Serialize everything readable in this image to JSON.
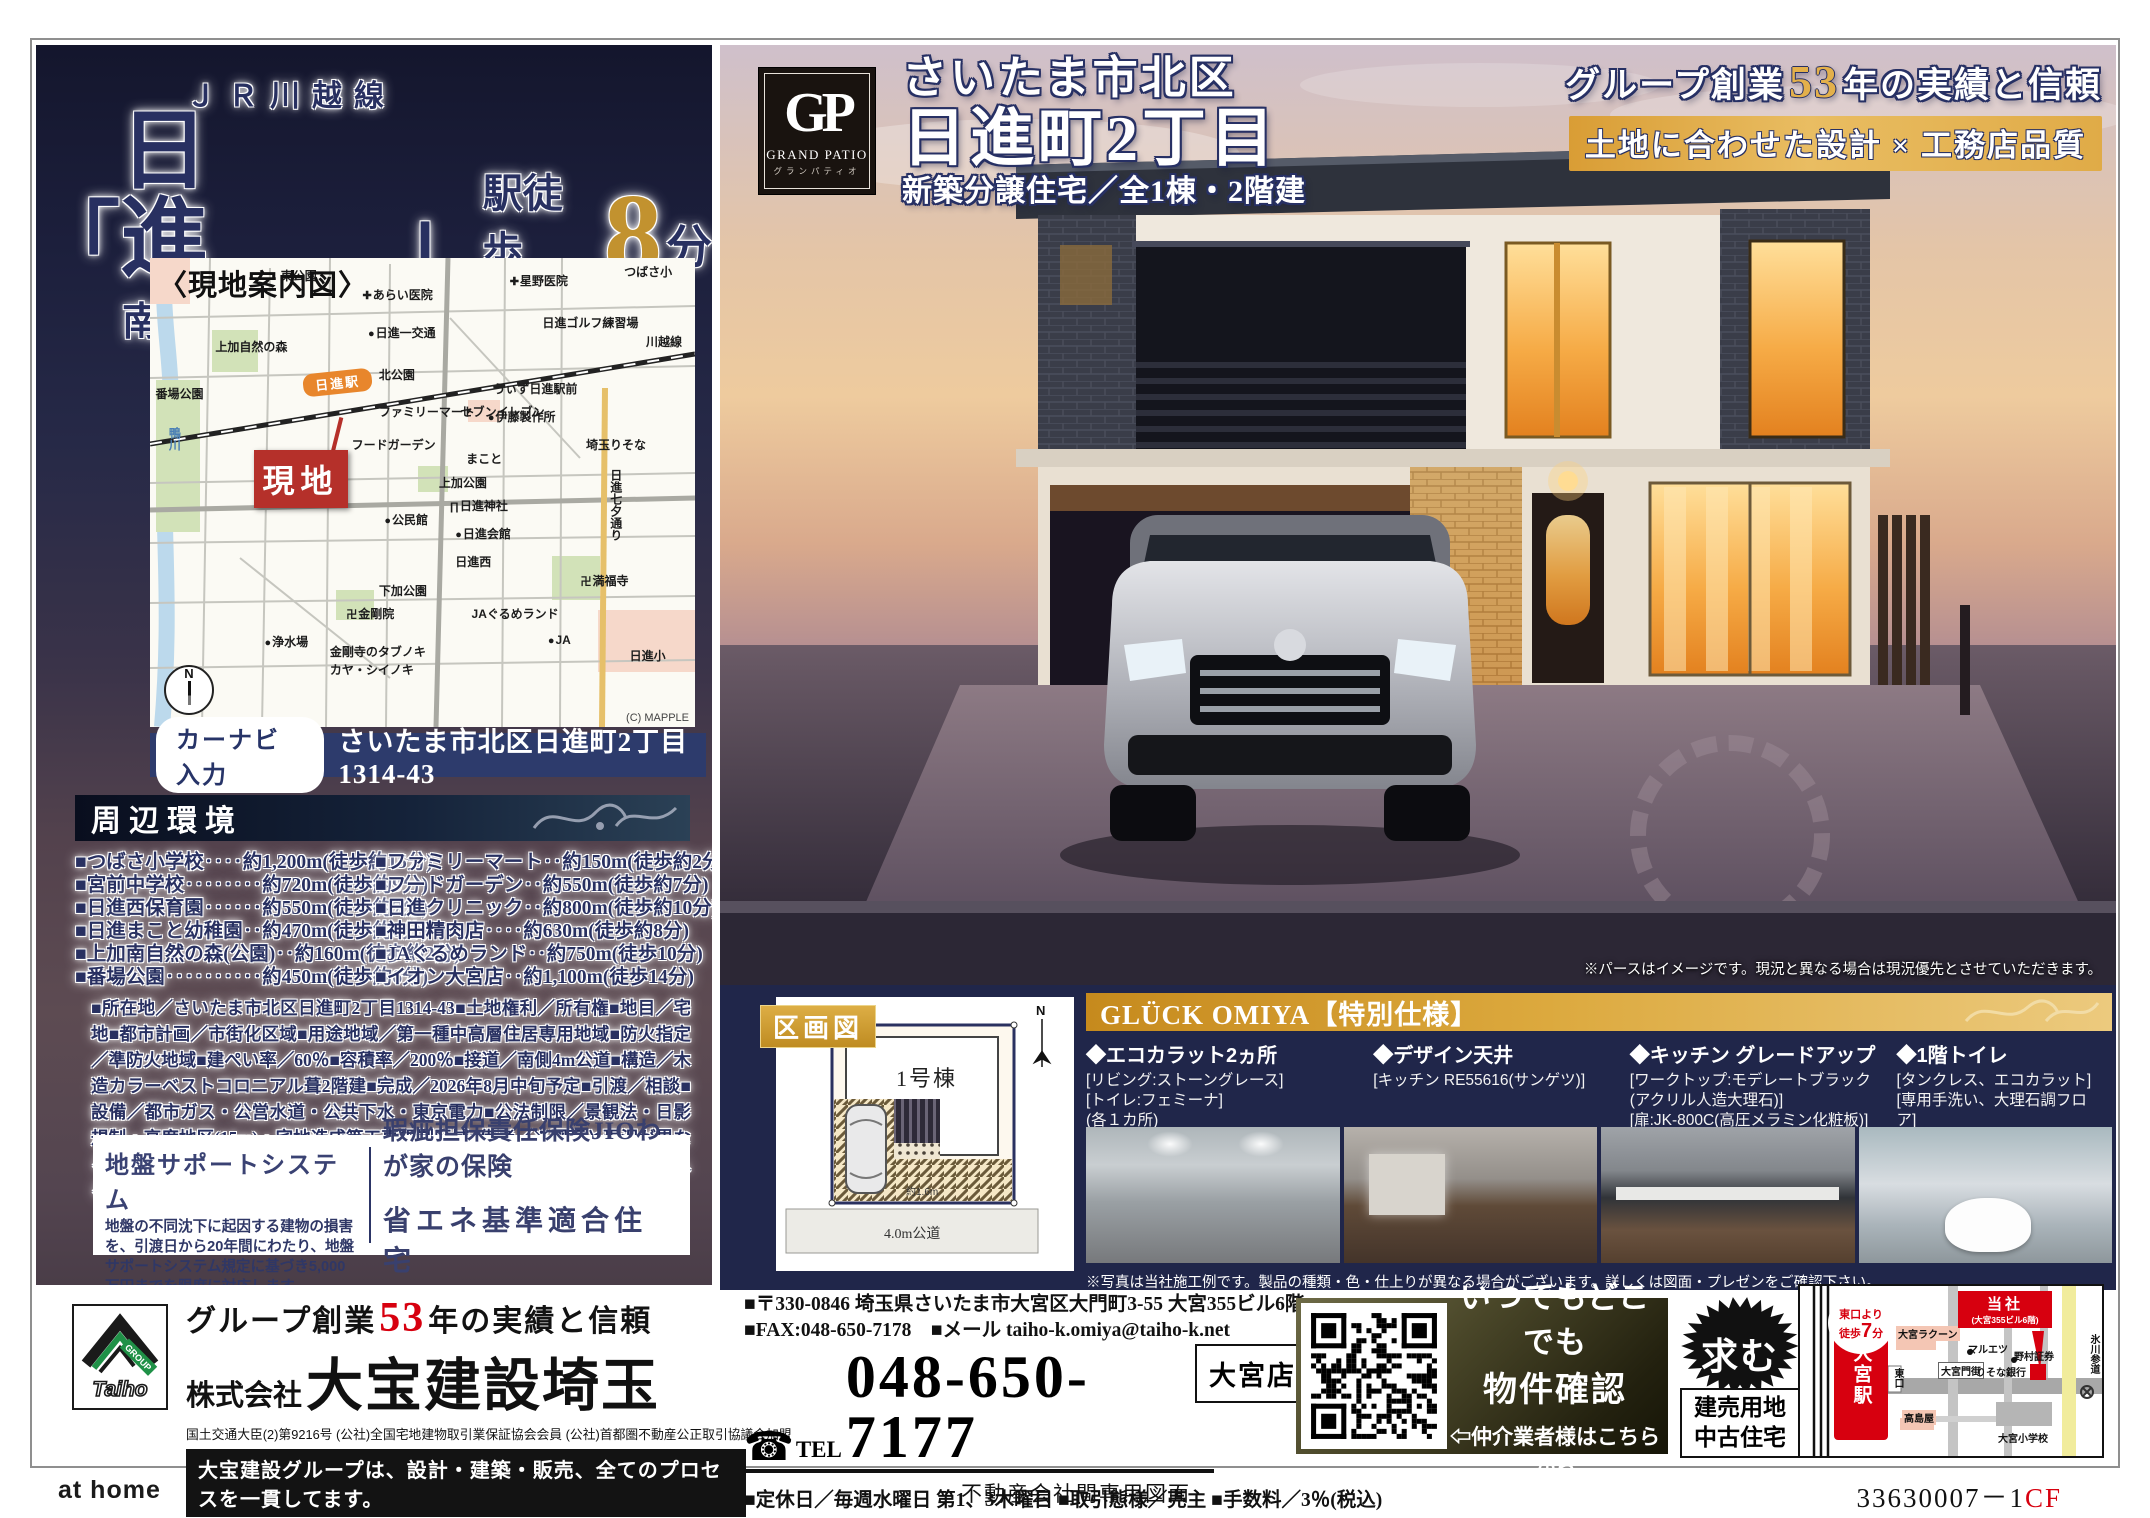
{
  "colors": {
    "navy": "#283061",
    "gold": "#c2922f",
    "red": "#d7000f",
    "panel_navy": "#20264a",
    "accent_gold_bar": "#dca93e"
  },
  "left": {
    "train_line": "ＪＲ川越線",
    "quote_open": "「",
    "station_name": "日　進",
    "quote_close": "」",
    "walk_label": "駅徒歩",
    "walk_minutes": "8",
    "walk_unit": "分",
    "subtitle": "南道路のため陽あたり良好",
    "map": {
      "title": "〈現地案内図〉",
      "site_label": "現地",
      "station_label": "日進駅",
      "credit": "(C) MAPPLE",
      "compass": "N",
      "labels": [
        {
          "t": "東公園",
          "x": 24,
          "y": 2
        },
        {
          "t": "あらい医院",
          "x": 39,
          "y": 6,
          "icon": "hospital"
        },
        {
          "t": "星野医院",
          "x": 66,
          "y": 3,
          "icon": "hospital"
        },
        {
          "t": "つばさ小",
          "x": 87,
          "y": 1
        },
        {
          "t": "日進ゴルフ練習場",
          "x": 72,
          "y": 12
        },
        {
          "t": "日進一交通",
          "x": 40,
          "y": 14,
          "icon": "dot"
        },
        {
          "t": "上加自然の森",
          "x": 12,
          "y": 17
        },
        {
          "t": "北公園",
          "x": 42,
          "y": 23
        },
        {
          "t": "番場公園",
          "x": 1,
          "y": 27
        },
        {
          "t": "うぃず日進駅前",
          "x": 63,
          "y": 26
        },
        {
          "t": "伊藤製作所",
          "x": 62,
          "y": 32,
          "icon": "dot"
        },
        {
          "t": "ファミリーマート",
          "x": 42,
          "y": 31
        },
        {
          "t": "セブンイレブン",
          "x": 57,
          "y": 31
        },
        {
          "t": "川越線",
          "x": 91,
          "y": 16
        },
        {
          "t": "フードガーデン",
          "x": 37,
          "y": 38
        },
        {
          "t": "まこと",
          "x": 58,
          "y": 41
        },
        {
          "t": "埼玉りそな",
          "x": 80,
          "y": 38
        },
        {
          "t": "鴨川",
          "x": 3,
          "y": 36,
          "vert": true,
          "river": true
        },
        {
          "t": "上加公園",
          "x": 53,
          "y": 46
        },
        {
          "t": "日進神社",
          "x": 55,
          "y": 51,
          "icon": "torii"
        },
        {
          "t": "公民館",
          "x": 43,
          "y": 54,
          "icon": "dot"
        },
        {
          "t": "日進会館",
          "x": 56,
          "y": 57,
          "icon": "dot"
        },
        {
          "t": "日進七夕通り",
          "x": 84,
          "y": 45,
          "vert": true
        },
        {
          "t": "日進西",
          "x": 56,
          "y": 63
        },
        {
          "t": "下加公園",
          "x": 42,
          "y": 69
        },
        {
          "t": "満福寺",
          "x": 79,
          "y": 67,
          "icon": "temple"
        },
        {
          "t": "金剛院",
          "x": 36,
          "y": 74,
          "icon": "temple"
        },
        {
          "t": "JAぐるめランド",
          "x": 59,
          "y": 74
        },
        {
          "t": "浄水場",
          "x": 21,
          "y": 80,
          "icon": "dot"
        },
        {
          "t": "金剛寺のタブノキ",
          "x": 33,
          "y": 82
        },
        {
          "t": "カヤ・シイノキ",
          "x": 33,
          "y": 86
        },
        {
          "t": "JA",
          "x": 73,
          "y": 80,
          "icon": "dot"
        },
        {
          "t": "日進小",
          "x": 88,
          "y": 83
        }
      ]
    },
    "carnav": {
      "label": "カーナビ入力",
      "address": "さいたま市北区日進町2丁目1314-43"
    },
    "surroundings": {
      "title": "周辺環境",
      "left_items": [
        "■つばさ小学校‥‥約1,200m(徒歩約15分)",
        "■宮前中学校‥‥‥‥約720m(徒歩約9分)",
        "■日進西保育園‥‥‥約550m(徒歩約7分)",
        "■日進まこと幼稚園‥約470m(徒歩約6分)",
        "■上加南自然の森(公園)‥約160m(徒歩約2分)",
        "■番場公園‥‥‥‥‥約450m(徒歩約6分)"
      ],
      "right_items": [
        "■ファミリーマート‥約150m(徒歩約2分)",
        "■フードガーデン‥約550m(徒歩約7分)",
        "■日進クリニック‥約800m(徒歩約10分)",
        "■神田精肉店‥‥約630m(徒歩約8分)",
        "■JAぐるめランド‥約750m(徒歩10分)",
        "■イオン大宮店‥約1,100m(徒歩14分)"
      ]
    },
    "property_details": "■所在地／さいたま市北区日進町2丁目1314-43■土地権利／所有権■地目／宅地■都市計画／市街化区域■用途地域／第一種中高層住居専用地域■防火指定／準防火地域■建ぺい率／60％■容積率／200％■接道／南側4m公道■構造／木造カラーベストコロニアル葺2階建■完成／2026年8月中旬予定■引渡／相談■設備／都市ガス・公営水道・公共下水・東京電力■公法制限／景観法・日影規制・高度地区(15m)・宅地造成等工事規制区域■備考／※図面と現況が異なる場合は現況優先とします。※電気の供給の為、敷地内に電柱及び支線が入る場合があります。",
    "ground_support": {
      "title": "地盤サポートシステム",
      "body": "地盤の不同沈下に起因する建物の損害を、引渡日から20年間にわたり、地盤サポートシステム規定に基づき5,000万円までを限度に対応します。"
    },
    "insurance": {
      "line1": "瑕疵担保責任保険JIOわが家の保険",
      "line2": "省エネ基準適合住宅"
    }
  },
  "hero": {
    "logo": {
      "monogram": "GP",
      "name": "GRAND PATIO",
      "kana": "グランパティオ"
    },
    "loc1": "さいたま市北区",
    "loc2": "日進町2丁目",
    "loc3": "新築分譲住宅／全1棟・2階建",
    "tag_pre": "グループ創業",
    "tag_num": "53",
    "tag_post": "年の実績と信頼",
    "banner": "土地に合わせた設計 × 工務店品質",
    "caption": "※パースはイメージです。現況と異なる場合は現況優先とさせていただきます。"
  },
  "plot": {
    "label": "区画図",
    "building": "1号棟",
    "setback": "約1.6m",
    "road": "4.0m公道",
    "compass": "N"
  },
  "specs": {
    "title": "GLÜCK OMIYA【特別仕様】",
    "items": [
      {
        "title": "◆エコカラット2ヵ所",
        "lines": [
          "[リビング:ストーングレース]",
          "[トイレ:フェミーナ]",
          "(各１カ所)"
        ]
      },
      {
        "title": "◆デザイン天井",
        "lines": [
          "[キッチン RE55616(サンゲツ)]"
        ]
      },
      {
        "title": "◆キッチン グレードアップ",
        "lines": [
          "[ワークトップ:モデレートブラック",
          "(アクリル人造大理石)]",
          "[扉:JK-800C(高圧メラミン化粧板)]"
        ]
      },
      {
        "title": "◆1階トイレ",
        "lines": [
          "[タンクレス、エコカラット]",
          "[専用手洗い、大理石調フロア]",
          "※リビング階"
        ]
      }
    ],
    "caption": "※写真は当社施工例です。製品の種類・色・仕上りが異なる場合がございます。詳しくは図面・プレゼンをご確認下さい。"
  },
  "footer": {
    "company": {
      "tag_pre": "グループ創業",
      "tag_num": "53",
      "tag_post": "年の実績と信頼",
      "prefix": "株式会社",
      "name": "大宝建設埼玉",
      "license": "国土交通大臣(2)第9216号 (公社)全国宅地建物取引業保証協会会員 (公社)首都圏不動産公正取引協議会加盟",
      "slogan": "大宝建設グループは、設計・建築・販売、全てのプロセスを一貫してます。",
      "logo_text": "Taiho",
      "logo_group": "GROUP"
    },
    "contact": {
      "address": "■〒330-0846 埼玉県さいたま市大宮区大門町3-55 大宮355ビル6階",
      "fax_mail": "■FAX:048-650-7178　■メール taiho-k.omiya@taiho-k.net",
      "tel_word": "TEL",
      "tel": "048-650-7177",
      "branch": "大宮店",
      "notes": "■定休日／毎週水曜日 第1、3木曜日 ■取引態様／売主 ■手数料／3％(税込)"
    },
    "qr": {
      "line1": "いつでもどこでも",
      "line2": "物件確認",
      "line3": "⇦仲介業者様はこちらから"
    },
    "wanted": {
      "badge": "求む",
      "line1": "建売用地",
      "line2": "中古住宅"
    },
    "minimap": {
      "station": "大宮駅",
      "walk_pre": "東口より",
      "walk_mid": "徒歩",
      "walk_num": "7",
      "walk_unit": "分",
      "company": "当社",
      "company_sub": "(大宮355ビル6階)",
      "labels": [
        {
          "t": "大宮ラクーン",
          "x": 96,
          "y": 40,
          "cls": "pink"
        },
        {
          "t": "マルエツ",
          "x": 168,
          "y": 55
        },
        {
          "t": "野村証券",
          "x": 214,
          "y": 62
        },
        {
          "t": "大宮門街",
          "x": 138,
          "y": 76,
          "cls": "boxed"
        },
        {
          "t": "りそな銀行",
          "x": 176,
          "y": 78
        },
        {
          "t": "東口",
          "x": 90,
          "y": 82,
          "cls": "vert"
        },
        {
          "t": "高島屋",
          "x": 102,
          "y": 124,
          "cls": "pink"
        },
        {
          "t": "大宮小学校",
          "x": 198,
          "y": 144
        },
        {
          "t": "氷川参道",
          "x": 286,
          "y": 48,
          "cls": "vert"
        }
      ]
    },
    "legal": {
      "athome": "at home",
      "center": "不動産会社間専用図面",
      "code": "33630007－1",
      "code_suffix": "CF"
    }
  }
}
